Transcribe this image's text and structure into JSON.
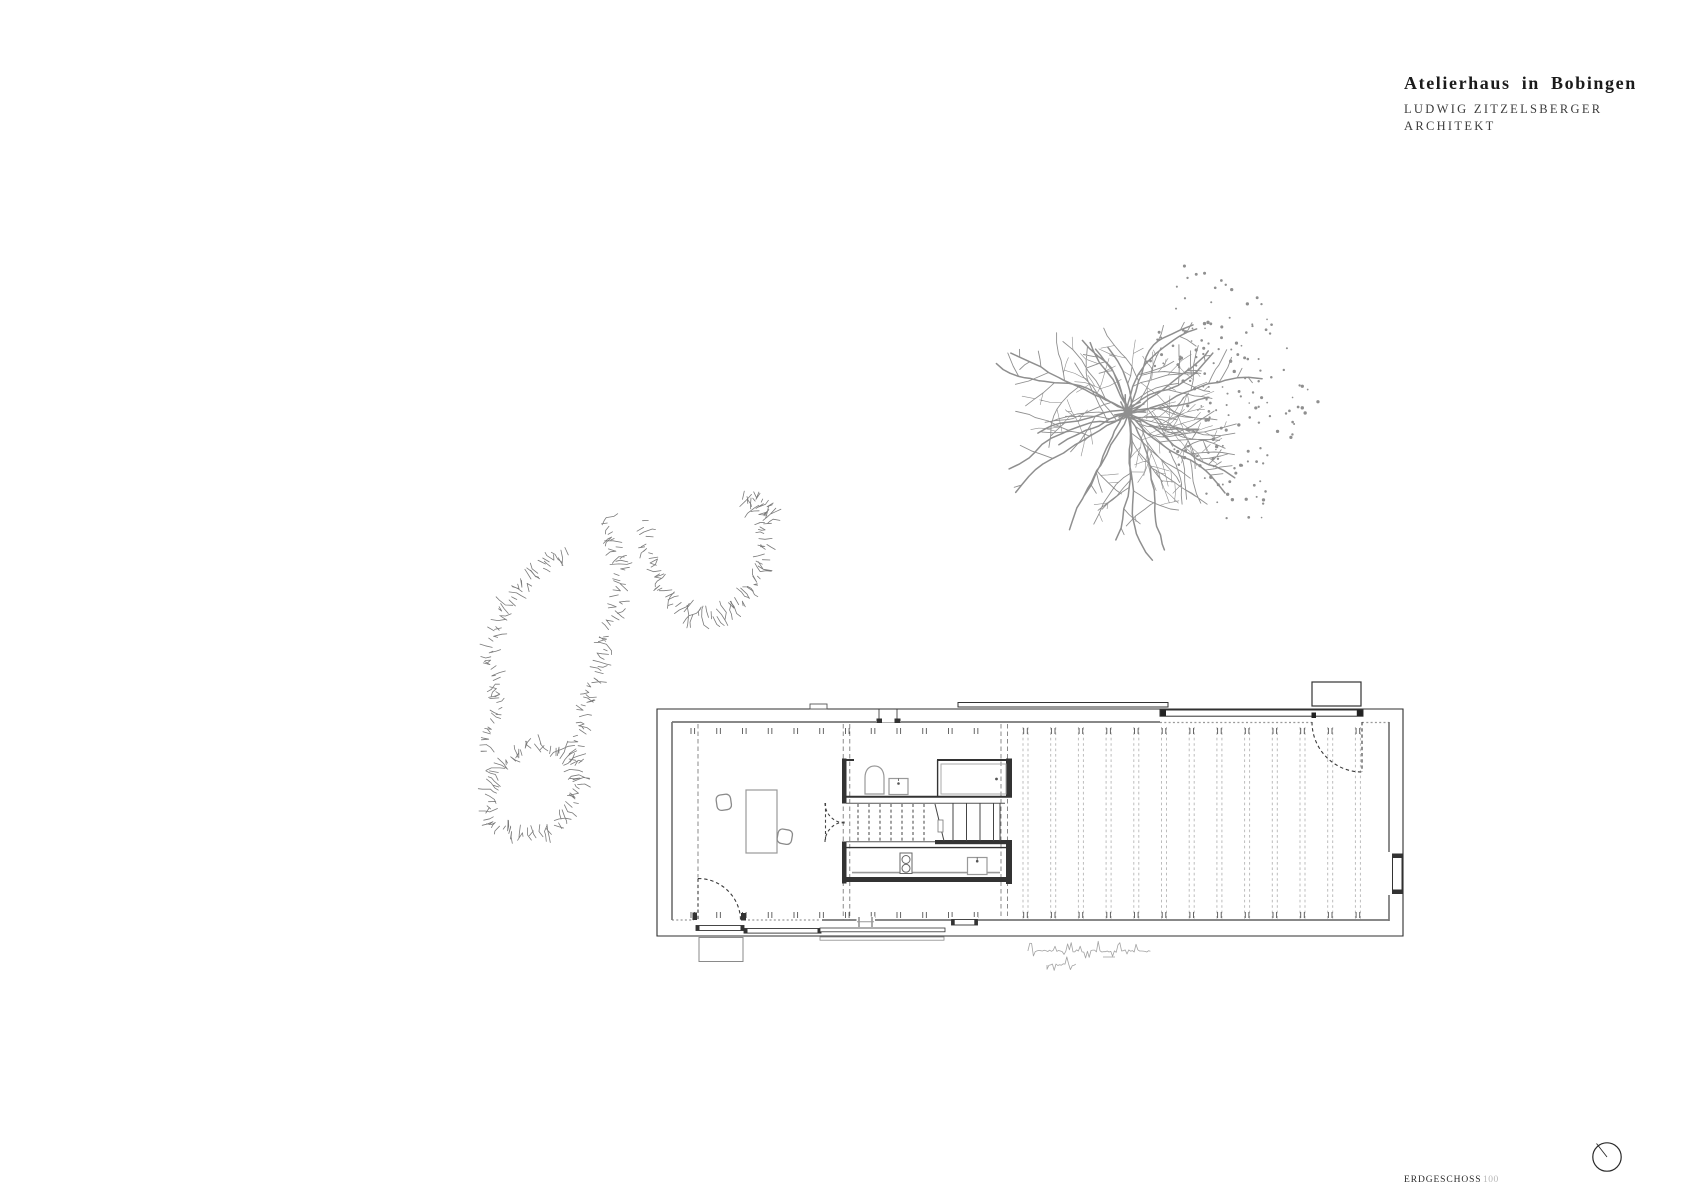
{
  "title_block": {
    "title": "Atelierhaus in Bobingen",
    "architect_line1": "LUDWIG ZITZELSBERGER",
    "architect_line2": "ARCHITEKT"
  },
  "footer": {
    "drawing_label": "ERDGESCHOSS",
    "scale_value": "100"
  },
  "icons": {
    "north_indicator": "north-circle-icon",
    "handwritten_note": "illegible pencil scribble"
  },
  "colors": {
    "line_dark": "#333333",
    "line_outer": "#2f2f2f",
    "line_mid": "#787878",
    "line_gray": "#999999",
    "line_light": "#b9b9b9",
    "axis": "#6e6e6e",
    "tree": "#8f8f8f",
    "shrub": "#7a7a7a",
    "pencil": "#a3a3a3",
    "fixture": "#555555"
  }
}
